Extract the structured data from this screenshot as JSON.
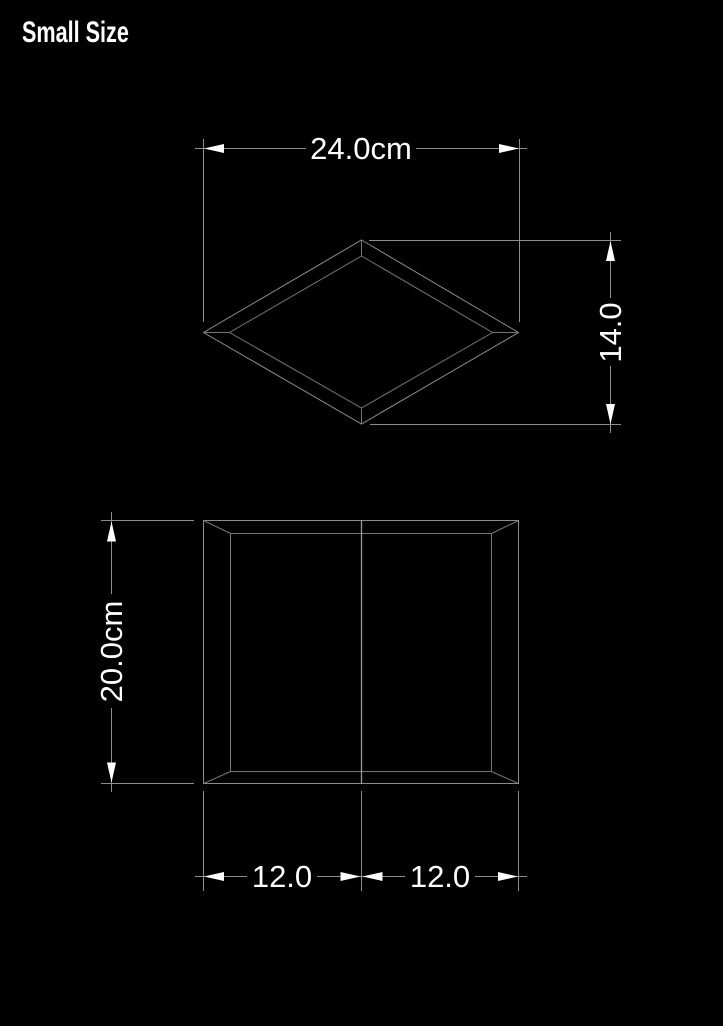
{
  "title": "Small Size",
  "colors": {
    "background": "#000000",
    "outline": "#8c8c8c",
    "inner_outline": "#757575",
    "dimension_line": "#8c8c8c",
    "text": "#ffffff",
    "arrowhead": "#ffffff"
  },
  "views": {
    "top": {
      "dimensions": {
        "width": "24.0cm",
        "depth": "14.0"
      }
    },
    "front": {
      "dimensions": {
        "height": "20.0cm",
        "width_left": "12.0",
        "width_right": "12.0"
      }
    }
  }
}
